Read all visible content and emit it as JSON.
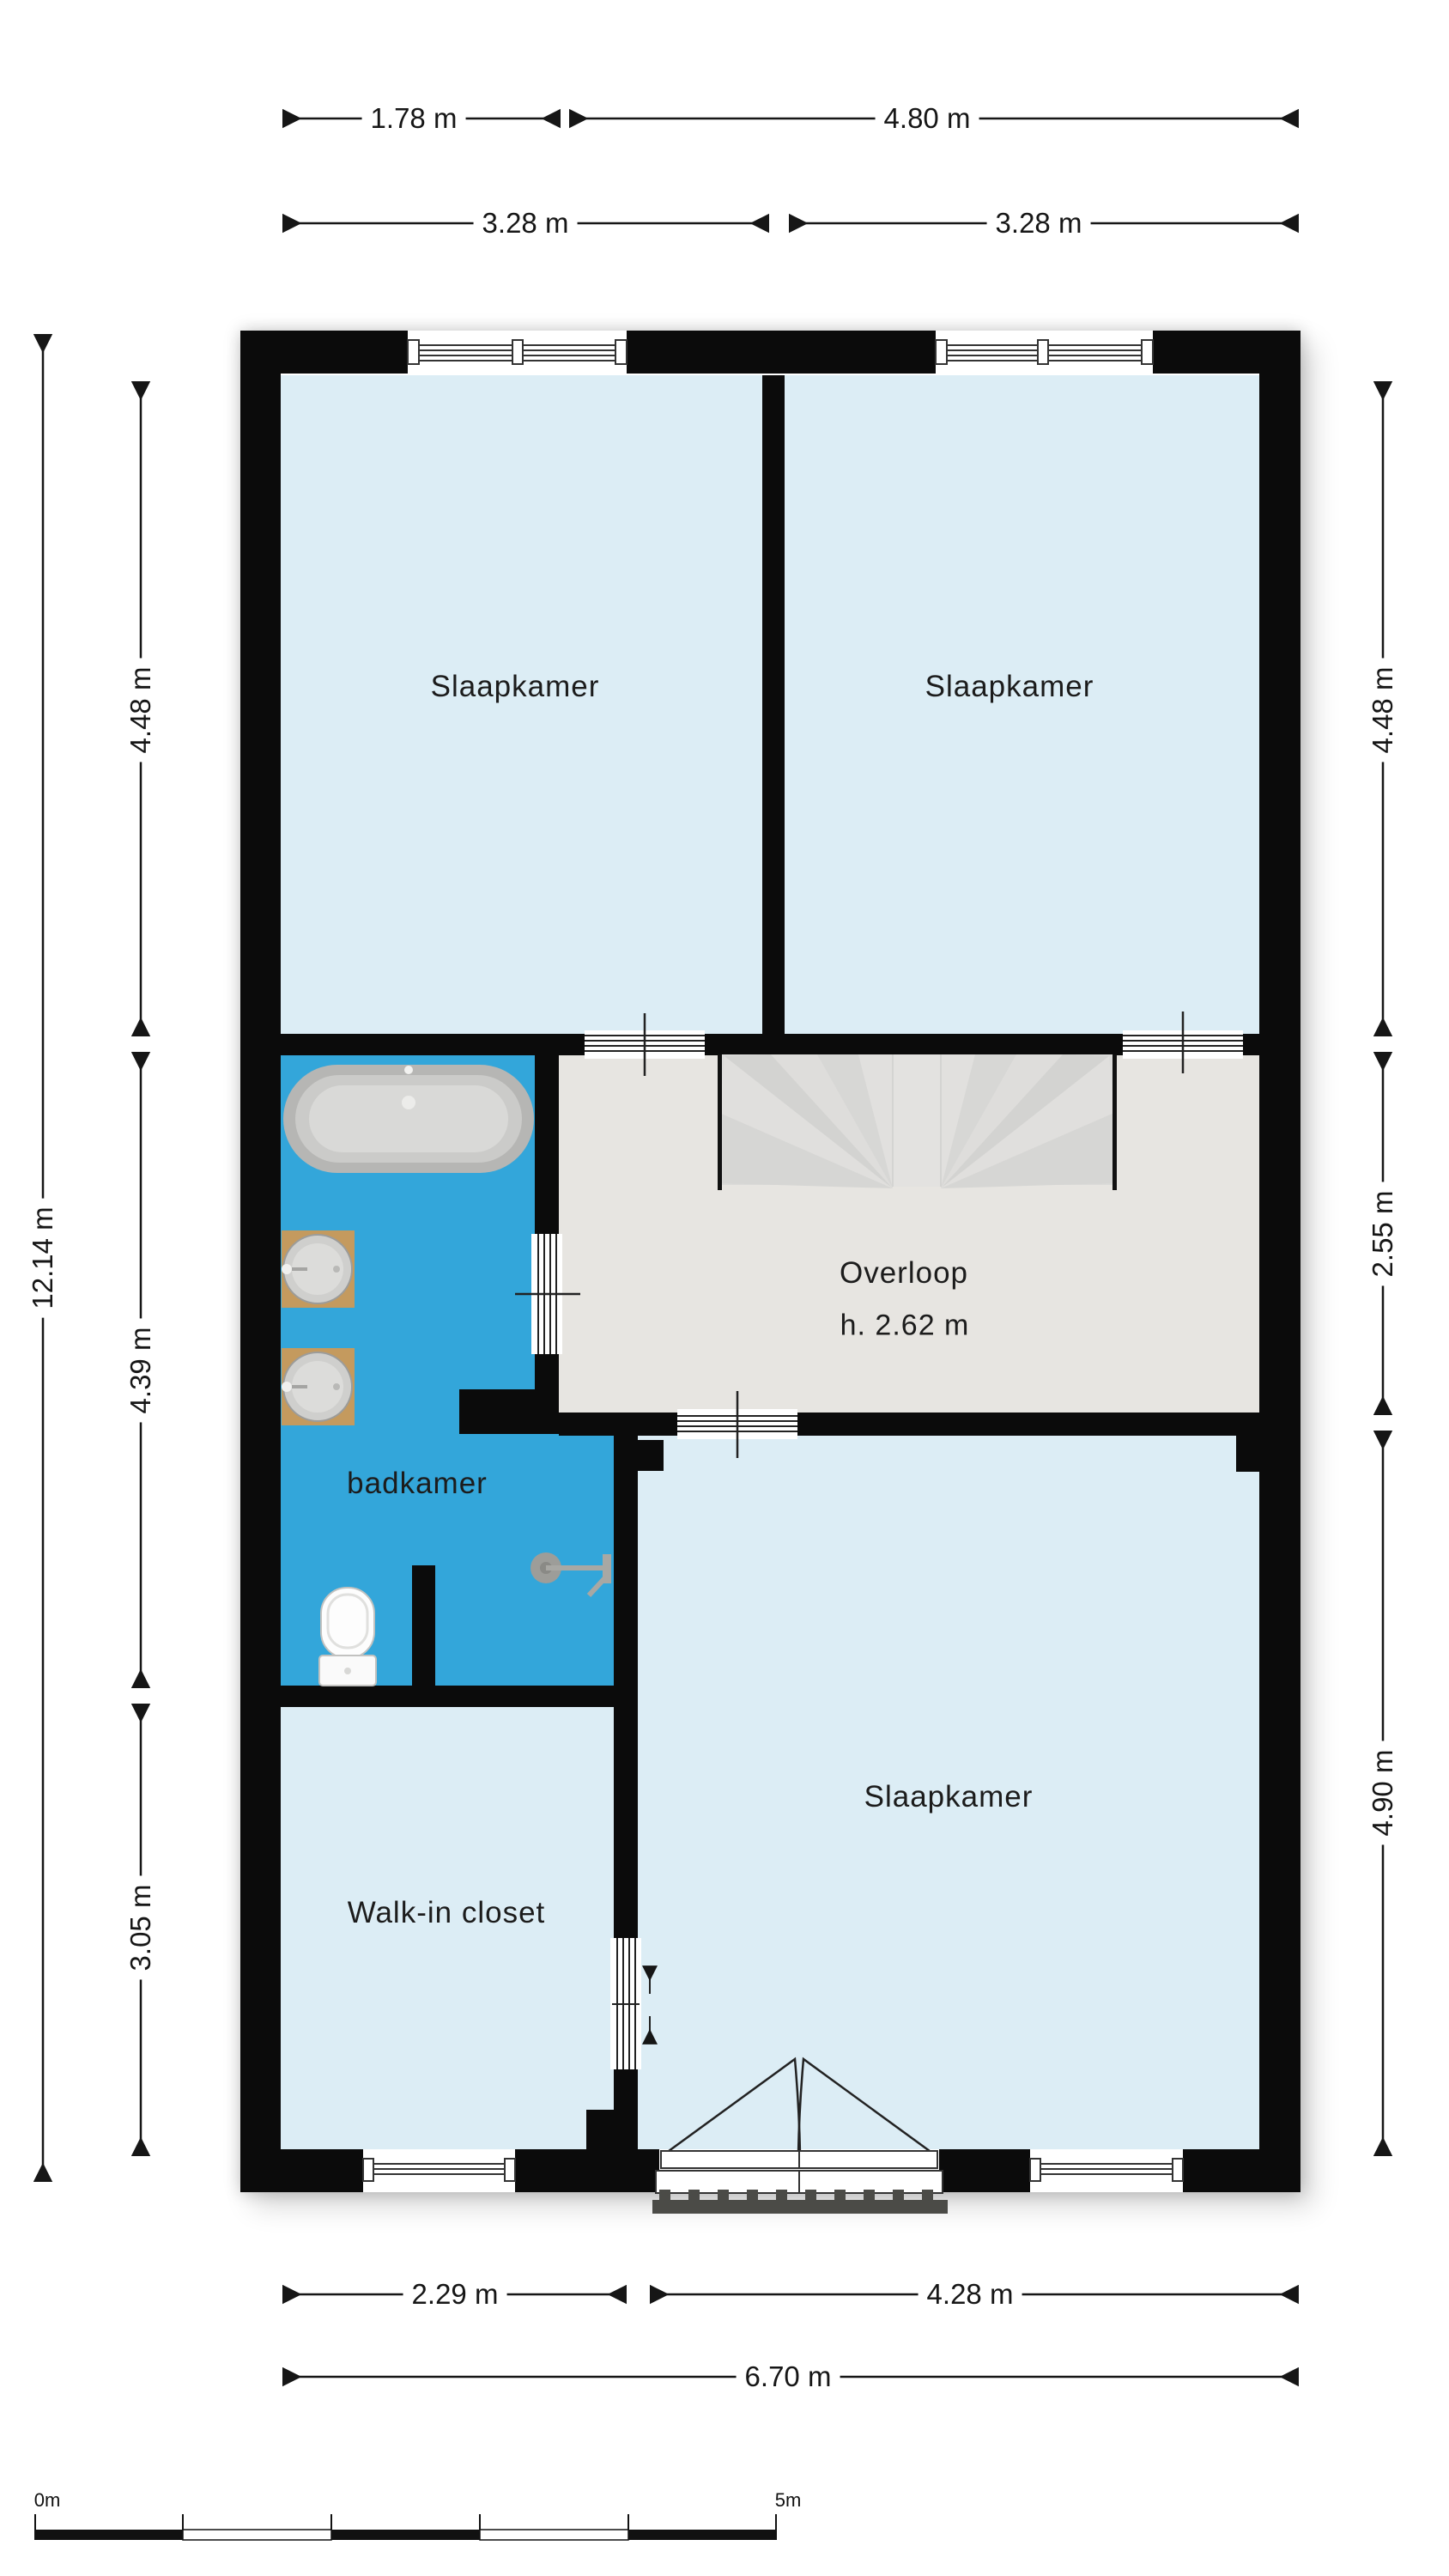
{
  "plan": {
    "rooms": {
      "bedroom_top_left": "Slaapkamer",
      "bedroom_top_right": "Slaapkamer",
      "landing": "Overloop",
      "landing_height": "h. 2.62 m",
      "bathroom": "badkamer",
      "closet": "Walk-in closet",
      "bedroom_bottom": "Slaapkamer"
    },
    "dimensions": {
      "top_row1": [
        "1.78 m",
        "4.80 m"
      ],
      "top_row2": [
        "3.28 m",
        "3.28 m"
      ],
      "left_outer": "12.14 m",
      "left_inner": [
        "4.48 m",
        "4.39 m",
        "3.05 m"
      ],
      "right": [
        "4.48 m",
        "2.55 m",
        "4.90 m"
      ],
      "bottom_row1": [
        "2.29 m",
        "4.28 m"
      ],
      "bottom_row2": "6.70 m"
    },
    "scale_bar": {
      "start_label": "0m",
      "end_label": "5m"
    },
    "fixtures": [
      "bathtub",
      "washbasin",
      "washbasin",
      "toilet",
      "shower-head",
      "winder-staircase",
      "french-doors",
      "balcony-grate"
    ],
    "colors": {
      "wall": "#0b0b0b",
      "bedroom": "#dcedf5",
      "bathroom": "#33a6da",
      "landing": "#e7e5e1",
      "stairs": "#dbdbd9",
      "wood": "#c49a5e",
      "ink": "#1a1a1a"
    }
  }
}
